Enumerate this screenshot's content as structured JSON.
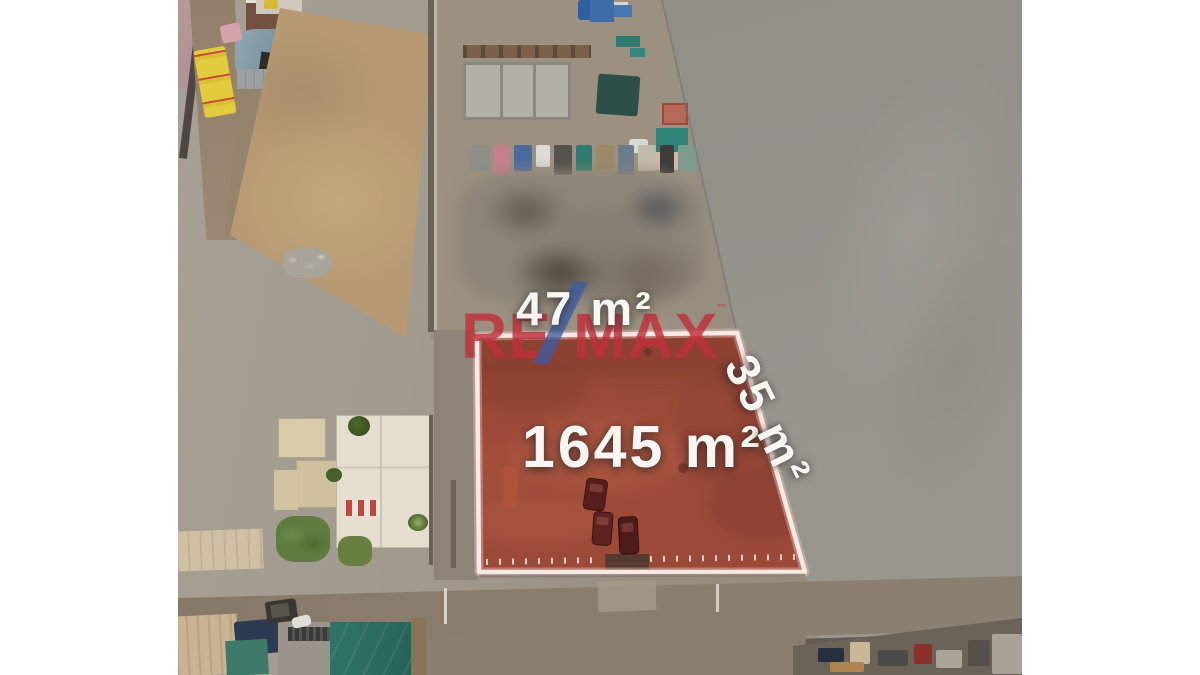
{
  "photo": {
    "type": "aerial-drone-photo-real-estate-listing",
    "labels": {
      "front_width": "47 m²",
      "side_depth": "35 m²",
      "total_area": "1645 m²"
    },
    "watermark": {
      "brand_left": "RE",
      "brand_right": "MAX",
      "trademark": "™"
    },
    "colors": {
      "brand_red": "#c22f3c",
      "brand_slash_blue": "#3a5ca6",
      "plot_fill_red": "#9c4a38",
      "plot_outline_white": "#f6e7e1",
      "label_text_white": "#f7f6f3",
      "gray_field": "#92908a",
      "tan_field": "#b79a73",
      "letterbox": "#ffffff"
    }
  }
}
